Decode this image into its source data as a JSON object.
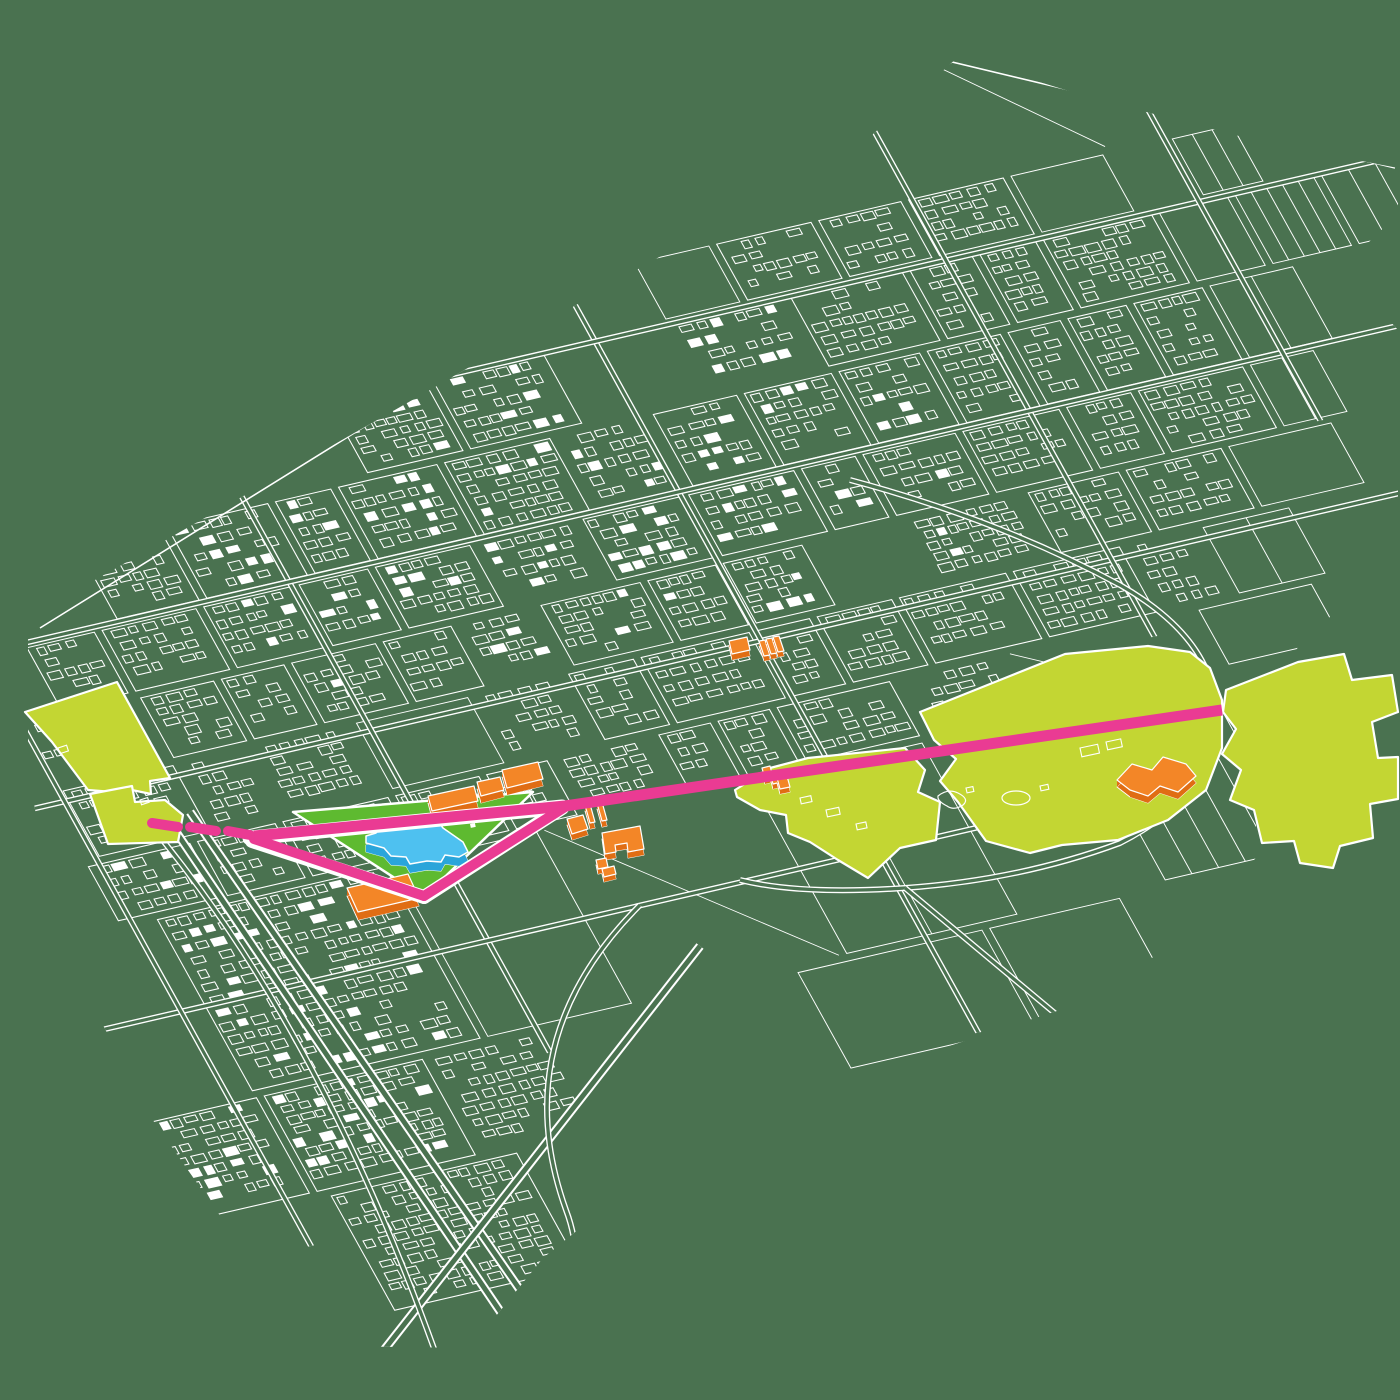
{
  "canvas": {
    "width": 1400,
    "height": 1400
  },
  "palette": {
    "background": "#4a7250",
    "line": "#ffffff",
    "lime": "#c3d633",
    "grass": "#5eba30",
    "blue_top": "#4ec1f0",
    "blue_side": "#2aa5da",
    "orange_top": "#f38627",
    "orange_side": "#e06d14",
    "magenta": "#ea3b93"
  },
  "map": {
    "seed": 20240613,
    "transform": {
      "a": 0.974,
      "b": -0.225,
      "c": 0.485,
      "d": 0.875,
      "e": 30,
      "f": 620
    },
    "clip": [
      [
        28,
        618
      ],
      [
        210,
        515
      ],
      [
        430,
        390
      ],
      [
        650,
        262
      ],
      [
        850,
        155
      ],
      [
        958,
        57
      ],
      [
        1085,
        96
      ],
      [
        1262,
        142
      ],
      [
        1398,
        168
      ],
      [
        1398,
        214
      ],
      [
        1342,
        268
      ],
      [
        1398,
        330
      ],
      [
        1398,
        556
      ],
      [
        1302,
        642
      ],
      [
        1256,
        704
      ],
      [
        1256,
        858
      ],
      [
        1150,
        960
      ],
      [
        1060,
        1010
      ],
      [
        900,
        1062
      ],
      [
        790,
        1082
      ],
      [
        620,
        1196
      ],
      [
        543,
        1258
      ],
      [
        470,
        1348
      ],
      [
        325,
        1346
      ],
      [
        230,
        1230
      ],
      [
        150,
        1116
      ],
      [
        60,
        942
      ],
      [
        28,
        772
      ]
    ],
    "local_bounds": {
      "x0": -460,
      "x1": 1560,
      "y0": -660,
      "y1": 870
    },
    "core_ellipses": [
      {
        "cx": 580,
        "cy": 20,
        "rx": 660,
        "ry": 310
      },
      {
        "cx": -40,
        "cy": 470,
        "rx": 280,
        "ry": 300
      }
    ],
    "local_roads": [
      {
        "dir": "h",
        "at": 192,
        "from": -420,
        "to": 1450
      },
      {
        "dir": "v",
        "at": 655,
        "from": -560,
        "to": 640
      },
      {
        "dir": "h",
        "at": -150,
        "from": -250,
        "to": 1500
      },
      {
        "dir": "v",
        "at": 255,
        "from": -460,
        "to": 560
      },
      {
        "dir": "v",
        "at": 1015,
        "from": -600,
        "to": 280
      },
      {
        "dir": "h",
        "at": 432,
        "from": -380,
        "to": 780
      },
      {
        "dir": "h",
        "at": 22,
        "from": -350,
        "to": 1450
      },
      {
        "dir": "v",
        "at": -60,
        "from": -80,
        "to": 700
      },
      {
        "dir": "v",
        "at": 1275,
        "from": -620,
        "to": 100
      },
      {
        "dir": "h",
        "at": -360,
        "from": 700,
        "to": 1550
      }
    ],
    "screen_roads": [
      {
        "name": "ring-road",
        "d": "M850,480 Q1000,520 1120,585 Q1225,645 1215,730 Q1205,800 1120,843 Q1020,880 905,888 Q800,895 740,880",
        "w": 6
      },
      {
        "name": "southeast-road",
        "d": "M905,888 L1185,1122",
        "w": 6
      },
      {
        "name": "motorway-a",
        "d": "M168,820 L560,1400",
        "w": 9
      },
      {
        "name": "motorway-b",
        "d": "M190,812 L596,1400",
        "w": 9
      },
      {
        "name": "motorway-c",
        "d": "M700,946 L345,1400",
        "w": 9
      },
      {
        "name": "curved-road-west",
        "d": "M118,788 Q320,1010 452,1400",
        "w": 6
      },
      {
        "name": "ramp-road",
        "d": "M640,905 Q505,1040 566,1210 Q600,1300 520,1400",
        "w": 6
      }
    ],
    "boundary_roads": [
      "M40,628 L952,62 L1395,168"
    ]
  },
  "features": {
    "zones": [
      {
        "name": "green-zone-west-upper",
        "points": [
          [
            25,
            712
          ],
          [
            117,
            682
          ],
          [
            170,
            778
          ],
          [
            150,
            781
          ],
          [
            151,
            794
          ],
          [
            127,
            789
          ],
          [
            113,
            792
          ],
          [
            88,
            790
          ],
          [
            52,
            742
          ]
        ]
      },
      {
        "name": "green-zone-west-lower",
        "points": [
          [
            90,
            794
          ],
          [
            132,
            786
          ],
          [
            135,
            802
          ],
          [
            165,
            800
          ],
          [
            183,
            815
          ],
          [
            178,
            842
          ],
          [
            108,
            844
          ]
        ]
      },
      {
        "name": "green-zone-middle",
        "points": [
          [
            735,
            790
          ],
          [
            770,
            768
          ],
          [
            808,
            758
          ],
          [
            905,
            748
          ],
          [
            925,
            770
          ],
          [
            918,
            792
          ],
          [
            940,
            802
          ],
          [
            936,
            840
          ],
          [
            900,
            848
          ],
          [
            868,
            878
          ],
          [
            838,
            860
          ],
          [
            810,
            842
          ],
          [
            788,
            833
          ],
          [
            786,
            815
          ],
          [
            760,
            810
          ],
          [
            737,
            797
          ]
        ]
      },
      {
        "name": "green-zone-east-park",
        "points": [
          [
            920,
            712
          ],
          [
            1005,
            678
          ],
          [
            1065,
            654
          ],
          [
            1148,
            646
          ],
          [
            1190,
            652
          ],
          [
            1210,
            668
          ],
          [
            1222,
            700
          ],
          [
            1222,
            748
          ],
          [
            1206,
            790
          ],
          [
            1168,
            820
          ],
          [
            1118,
            840
          ],
          [
            1062,
            845
          ],
          [
            1030,
            853
          ],
          [
            986,
            841
          ],
          [
            958,
            802
          ],
          [
            940,
            781
          ],
          [
            956,
            759
          ],
          [
            934,
            740
          ]
        ]
      },
      {
        "name": "green-zone-far-east",
        "points": [
          [
            1226,
            690
          ],
          [
            1298,
            662
          ],
          [
            1344,
            654
          ],
          [
            1352,
            680
          ],
          [
            1392,
            675
          ],
          [
            1398,
            712
          ],
          [
            1372,
            722
          ],
          [
            1378,
            758
          ],
          [
            1398,
            757
          ],
          [
            1398,
            799
          ],
          [
            1370,
            804
          ],
          [
            1373,
            838
          ],
          [
            1340,
            846
          ],
          [
            1333,
            868
          ],
          [
            1300,
            863
          ],
          [
            1294,
            841
          ],
          [
            1262,
            843
          ],
          [
            1254,
            810
          ],
          [
            1230,
            800
          ],
          [
            1241,
            770
          ],
          [
            1222,
            754
          ],
          [
            1236,
            729
          ],
          [
            1223,
            712
          ]
        ]
      }
    ],
    "zone_marks": [
      {
        "type": "ellipse",
        "cx": 1016,
        "cy": 798,
        "rx": 14,
        "ry": 7
      },
      {
        "type": "path",
        "d": "M938,796 q10,-8 20,-3 q12,6 5,12 q-9,6 -16,1 q-10,-5 -9,-10 z"
      },
      {
        "type": "rect",
        "x": 1080,
        "y": 748,
        "w": 18,
        "h": 9,
        "rot": -12
      },
      {
        "type": "rect",
        "x": 1106,
        "y": 742,
        "w": 15,
        "h": 8,
        "rot": -12
      },
      {
        "type": "rect",
        "x": 966,
        "y": 788,
        "w": 7,
        "h": 5,
        "rot": -12
      },
      {
        "type": "rect",
        "x": 1040,
        "y": 786,
        "w": 8,
        "h": 5,
        "rot": -12
      },
      {
        "type": "rect",
        "x": 800,
        "y": 798,
        "w": 11,
        "h": 6,
        "rot": -12
      },
      {
        "type": "rect",
        "x": 826,
        "y": 810,
        "w": 13,
        "h": 7,
        "rot": -12
      },
      {
        "type": "rect",
        "x": 856,
        "y": 824,
        "w": 10,
        "h": 6,
        "rot": -12
      },
      {
        "type": "rect",
        "x": 58,
        "y": 748,
        "w": 9,
        "h": 6,
        "rot": -18
      },
      {
        "type": "rect",
        "x": 140,
        "y": 800,
        "w": 8,
        "h": 5,
        "rot": -18
      }
    ],
    "site": {
      "name": "project-site",
      "points": [
        [
          293,
          812
        ],
        [
          533,
          792
        ],
        [
          424,
          897
        ]
      ]
    },
    "site_marks": [
      {
        "type": "rect",
        "x": 318,
        "y": 860,
        "w": 6,
        "h": 4,
        "rot": -12
      },
      {
        "type": "rect",
        "x": 470,
        "y": 824,
        "w": 5,
        "h": 4,
        "rot": -12
      }
    ],
    "blue_building": {
      "name": "proposed-main-building",
      "extrude": 9,
      "top": [
        [
          380,
          825
        ],
        [
          437,
          820
        ],
        [
          443,
          828
        ],
        [
          463,
          842
        ],
        [
          468,
          852
        ],
        [
          459,
          857
        ],
        [
          445,
          855
        ],
        [
          441,
          862
        ],
        [
          427,
          861
        ],
        [
          410,
          864
        ],
        [
          406,
          857
        ],
        [
          391,
          856
        ],
        [
          384,
          848
        ],
        [
          366,
          843
        ],
        [
          366,
          836
        ],
        [
          376,
          833
        ]
      ]
    },
    "orange_buildings": [
      {
        "name": "orange-building-1",
        "extrude": 7,
        "top": [
          [
            428,
            796
          ],
          [
            474,
            786
          ],
          [
            478,
            801
          ],
          [
            432,
            811
          ]
        ]
      },
      {
        "name": "orange-building-2",
        "extrude": 7,
        "top": [
          [
            477,
            782
          ],
          [
            500,
            777
          ],
          [
            504,
            790
          ],
          [
            481,
            796
          ]
        ]
      },
      {
        "name": "orange-building-3",
        "extrude": 7,
        "top": [
          [
            502,
            770
          ],
          [
            538,
            762
          ],
          [
            543,
            779
          ],
          [
            507,
            788
          ]
        ]
      },
      {
        "name": "orange-building-4",
        "extrude": 6,
        "top": [
          [
            567,
            819
          ],
          [
            583,
            815
          ],
          [
            588,
            829
          ],
          [
            572,
            834
          ]
        ]
      },
      {
        "name": "orange-building-5",
        "extrude": 6,
        "top": [
          [
            585,
            805
          ],
          [
            590,
            804
          ],
          [
            595,
            822
          ],
          [
            590,
            823
          ]
        ]
      },
      {
        "name": "orange-building-6",
        "extrude": 6,
        "top": [
          [
            597,
            803
          ],
          [
            602,
            802
          ],
          [
            607,
            820
          ],
          [
            602,
            821
          ]
        ]
      },
      {
        "name": "orange-building-7",
        "extrude": 6,
        "top": [
          [
            602,
            833
          ],
          [
            640,
            826
          ],
          [
            644,
            849
          ],
          [
            628,
            852
          ],
          [
            627,
            843
          ],
          [
            615,
            845
          ],
          [
            616,
            852
          ],
          [
            605,
            854
          ]
        ]
      },
      {
        "name": "orange-building-8",
        "extrude": 5,
        "top": [
          [
            596,
            860
          ],
          [
            606,
            858
          ],
          [
            608,
            867
          ],
          [
            598,
            869
          ]
        ]
      },
      {
        "name": "orange-building-9",
        "extrude": 5,
        "top": [
          [
            602,
            869
          ],
          [
            614,
            866
          ],
          [
            616,
            874
          ],
          [
            604,
            877
          ]
        ]
      },
      {
        "name": "orange-building-10",
        "extrude": 6,
        "top": [
          [
            729,
            641
          ],
          [
            747,
            637
          ],
          [
            750,
            650
          ],
          [
            732,
            654
          ]
        ]
      },
      {
        "name": "orange-building-11",
        "extrude": 5,
        "top": [
          [
            759,
            641
          ],
          [
            765,
            640
          ],
          [
            770,
            655
          ],
          [
            764,
            656
          ]
        ]
      },
      {
        "name": "orange-building-12",
        "extrude": 5,
        "top": [
          [
            766,
            639
          ],
          [
            772,
            638
          ],
          [
            777,
            653
          ],
          [
            771,
            654
          ]
        ]
      },
      {
        "name": "orange-building-13",
        "extrude": 5,
        "top": [
          [
            773,
            637
          ],
          [
            779,
            636
          ],
          [
            784,
            651
          ],
          [
            778,
            652
          ]
        ]
      },
      {
        "name": "orange-building-14",
        "extrude": 5,
        "top": [
          [
            762,
            768
          ],
          [
            770,
            766
          ],
          [
            773,
            777
          ],
          [
            765,
            779
          ]
        ]
      },
      {
        "name": "orange-building-15",
        "extrude": 5,
        "top": [
          [
            770,
            773
          ],
          [
            778,
            771
          ],
          [
            781,
            782
          ],
          [
            773,
            784
          ]
        ]
      },
      {
        "name": "orange-building-16",
        "extrude": 5,
        "top": [
          [
            777,
            778
          ],
          [
            787,
            776
          ],
          [
            790,
            787
          ],
          [
            780,
            789
          ]
        ]
      },
      {
        "name": "orange-building-17",
        "extrude": 8,
        "top": [
          [
            347,
            888
          ],
          [
            408,
            874
          ],
          [
            419,
            898
          ],
          [
            358,
            912
          ]
        ]
      },
      {
        "name": "orange-building-18",
        "extrude": 7,
        "top": [
          [
            1117,
            780
          ],
          [
            1132,
            764
          ],
          [
            1152,
            770
          ],
          [
            1163,
            757
          ],
          [
            1186,
            764
          ],
          [
            1196,
            776
          ],
          [
            1178,
            792
          ],
          [
            1160,
            786
          ],
          [
            1148,
            796
          ],
          [
            1130,
            790
          ]
        ]
      }
    ],
    "route": {
      "name": "proposed-route",
      "width": 11,
      "underlays": [
        {
          "pts": [
            [
              250,
              838
            ],
            [
              562,
              807
            ]
          ],
          "w": 15
        },
        {
          "pts": [
            [
              252,
              841
            ],
            [
              424,
              897
            ]
          ],
          "w": 14
        },
        {
          "pts": [
            [
              424,
              897
            ],
            [
              562,
              808
            ]
          ],
          "w": 14
        }
      ],
      "main": [
        [
          254,
          836
        ],
        [
          565,
          806
        ],
        [
          1222,
          710
        ]
      ],
      "arms": [
        {
          "pts": [
            [
              254,
              839
            ],
            [
              424,
              896
            ]
          ],
          "w": 10
        },
        {
          "pts": [
            [
              424,
              896
            ],
            [
              565,
              807
            ]
          ],
          "w": 10
        }
      ],
      "dashes": [
        [
          [
            152,
            823
          ],
          [
            178,
            827
          ]
        ],
        [
          [
            190,
            827
          ],
          [
            216,
            831
          ]
        ],
        [
          [
            228,
            831
          ],
          [
            250,
            835
          ]
        ]
      ]
    }
  }
}
